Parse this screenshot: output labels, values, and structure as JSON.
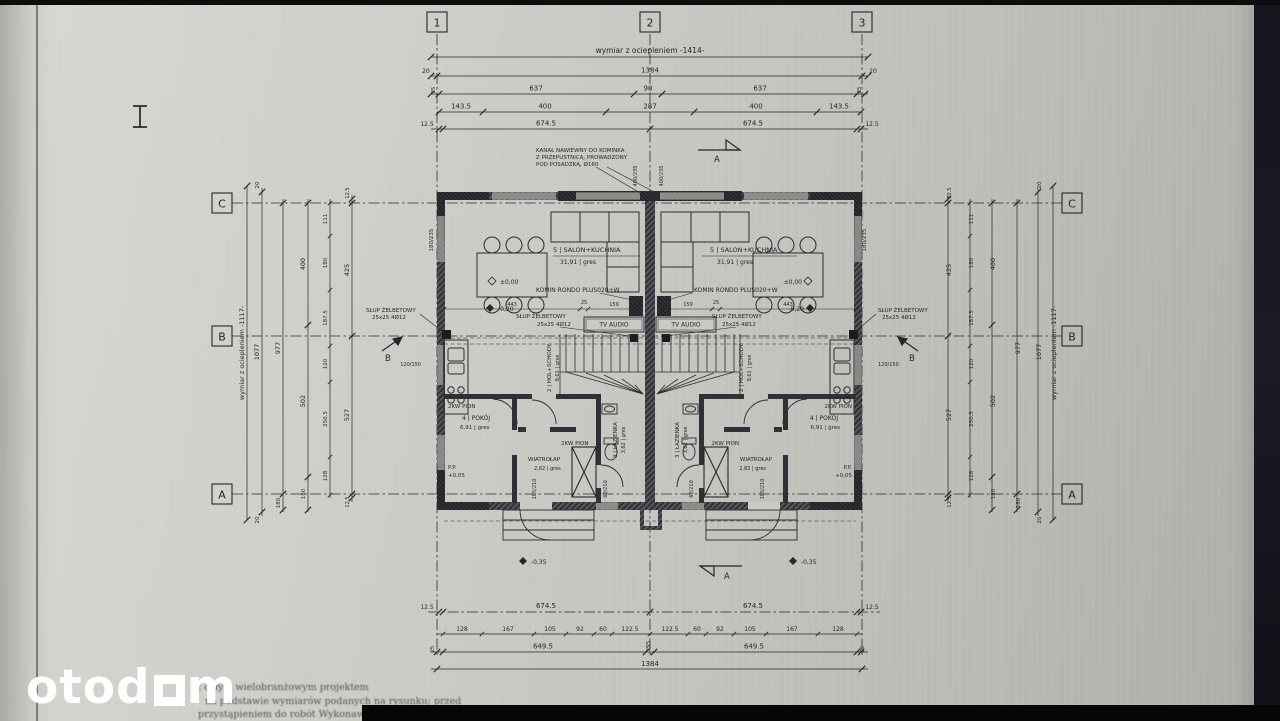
{
  "chrome": {
    "logo_prefix": "otod",
    "logo_suffix": "m"
  },
  "notes": {
    "line1": "z całym wielobranżowym projektem",
    "line2": "na podstawie wymiarów podanych na rysunku; przed",
    "line3": "przystąpieniem do robót Wykonawca powinien sprawdzić na budowie wszystkie rzędne"
  },
  "axes": {
    "v": [
      "1",
      "2",
      "3"
    ],
    "h": [
      "C",
      "B",
      "A"
    ]
  },
  "dims": {
    "top": {
      "title": "wymiar z ociepleniem -1414-",
      "margin": "20",
      "total": "1384",
      "row2": [
        "25",
        "637",
        "90",
        "637",
        "25"
      ],
      "row3": [
        "143.5",
        "400",
        "287",
        "400",
        "143.5"
      ],
      "row4": [
        "12.5",
        "674.5",
        "674.5",
        "12.5"
      ]
    },
    "bottom": {
      "row1": [
        "12.5",
        "674.5",
        "674.5",
        "12.5"
      ],
      "row2": [
        "128",
        "167",
        "105",
        "92",
        "60",
        "122.5",
        "25",
        "122.5",
        "60",
        "92",
        "105",
        "167",
        "128"
      ],
      "row3": [
        "25",
        "649.5",
        "25",
        "649.5",
        "25"
      ],
      "total": "1384"
    },
    "side": {
      "title": "wymiar z ociepleniem -1117-",
      "margin": "20",
      "total": "1077",
      "inner": "977",
      "seg_a": "180",
      "row3": [
        "400",
        "502",
        "180"
      ],
      "row4": [
        "111",
        "180",
        "187.5",
        "120",
        "250.5",
        "128"
      ],
      "row5": [
        "12.5",
        "425",
        "527",
        "12.5"
      ]
    },
    "inner": [
      "443",
      "25",
      "159"
    ]
  },
  "rooms": {
    "salon": {
      "title": "5 | SALON+KUCHNIA",
      "area": "31,91 | gres"
    },
    "hol": {
      "title": "2 | HOL+SCHODY",
      "area": "9,61 | gres"
    },
    "lazienka": {
      "title": "3 | ŁAZIENKA",
      "area": "3,62 | gres"
    },
    "pokoj": {
      "title": "4 | POKÓJ",
      "area": "6,91 | gres"
    },
    "wiatrolap": {
      "title": "WIATROŁAP",
      "area": "2,82 | gres"
    }
  },
  "labels": {
    "kanal1": "KANAŁ NAWIEWNY DO KOMINKA",
    "kanal2": "Z PRZEPUSTNICĄ, PROWADZONY",
    "kanal3": "POD POSADZKĄ, Ø160",
    "komin": "KOMIN RONDO PLUS020+W",
    "slup1": "SŁUP ŻELBETOWY",
    "slup2": "25x25 4Ø12",
    "tv": "TV AUDIO",
    "pion": "2KW PION",
    "pp": "P.P.",
    "lvl0": "±0,00",
    "lvlm20": "-0,20",
    "lvlp05": "+0,05",
    "lvlm35": "-0,35",
    "win_left": "180/235",
    "win_top": "400/235",
    "door_b": "105/210",
    "win_b": "60/210",
    "win_s": "120/150",
    "sec_a": "A",
    "sec_b": "B"
  },
  "colors": {
    "ink": "#26262b",
    "paper": "#c9c7c2",
    "wall": "#3c3c42"
  }
}
